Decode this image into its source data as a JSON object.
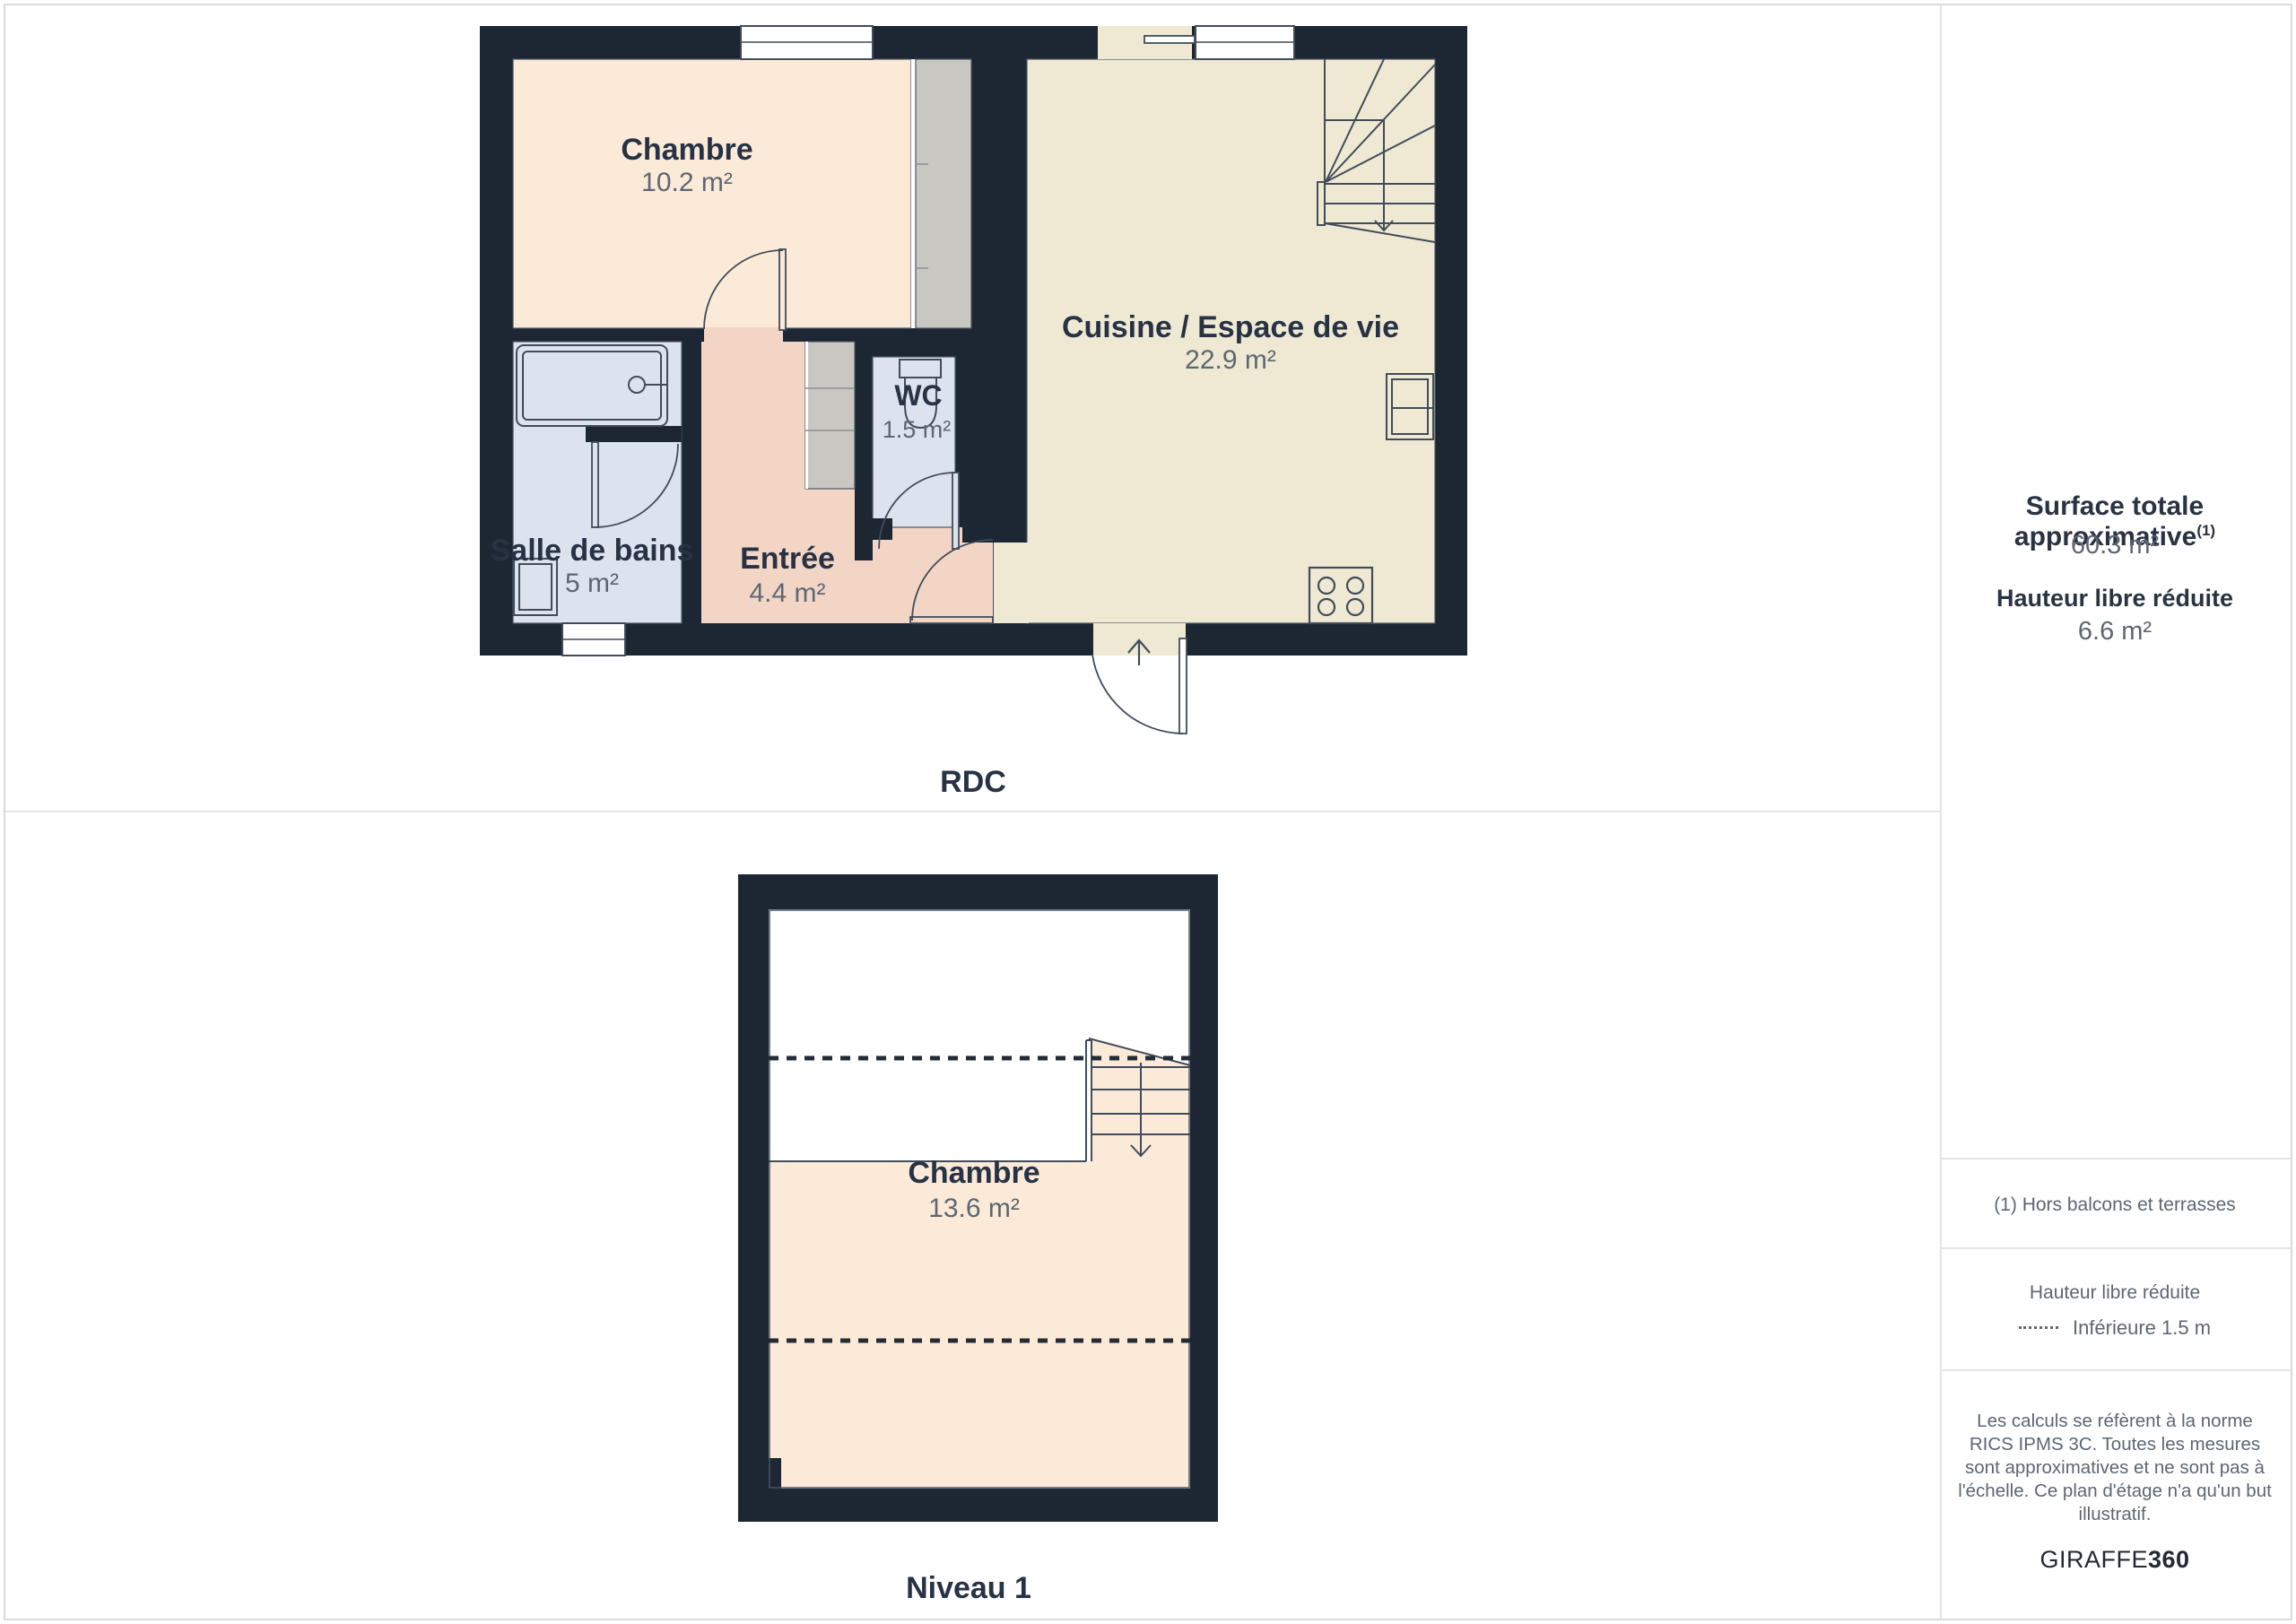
{
  "plans": {
    "rdc": {
      "label": "RDC",
      "rooms": {
        "chambre": {
          "name": "Chambre",
          "area": "10.2 m²"
        },
        "cuisine": {
          "name": "Cuisine / Espace de vie",
          "area": "22.9 m²"
        },
        "wc": {
          "name": "WC",
          "area": "1.5 m²"
        },
        "entree": {
          "name": "Entrée",
          "area": "4.4 m²"
        },
        "salle_de_bains": {
          "name": "Salle de bains",
          "area": "5 m²"
        }
      }
    },
    "niveau1": {
      "label": "Niveau 1",
      "rooms": {
        "chambre": {
          "name": "Chambre",
          "area": "13.6 m²"
        }
      }
    }
  },
  "sidebar": {
    "surface_title": "Surface totale approximative",
    "surface_sup": "(1)",
    "surface_value": "60.3 m²",
    "hauteur_title": "Hauteur libre réduite",
    "hauteur_value": "6.6 m²",
    "footnote": "(1) Hors balcons et terrasses",
    "legend_title": "Hauteur libre réduite",
    "legend_item": "Inférieure 1.5 m",
    "disclaimer": "Les calculs se réfèrent à la norme RICS IPMS 3C. Toutes les mesures sont approximatives et ne sont pas à l'échelle. Ce plan d'étage n'a qu'un but illustratif.",
    "brand": "GIRAFFE",
    "brand_bold": "360"
  },
  "colors": {
    "wall": "#1d2733",
    "floor_peach": "#fcead8",
    "floor_beige": "#efe9d4",
    "floor_salmon": "#f3d5c5",
    "floor_blue": "#dde3ee",
    "closet_gray": "#c9c7c2",
    "plan_line": "#414c5a",
    "room_name_text": "#273245",
    "area_text": "#5d6673",
    "divider": "#e5e5e7"
  }
}
